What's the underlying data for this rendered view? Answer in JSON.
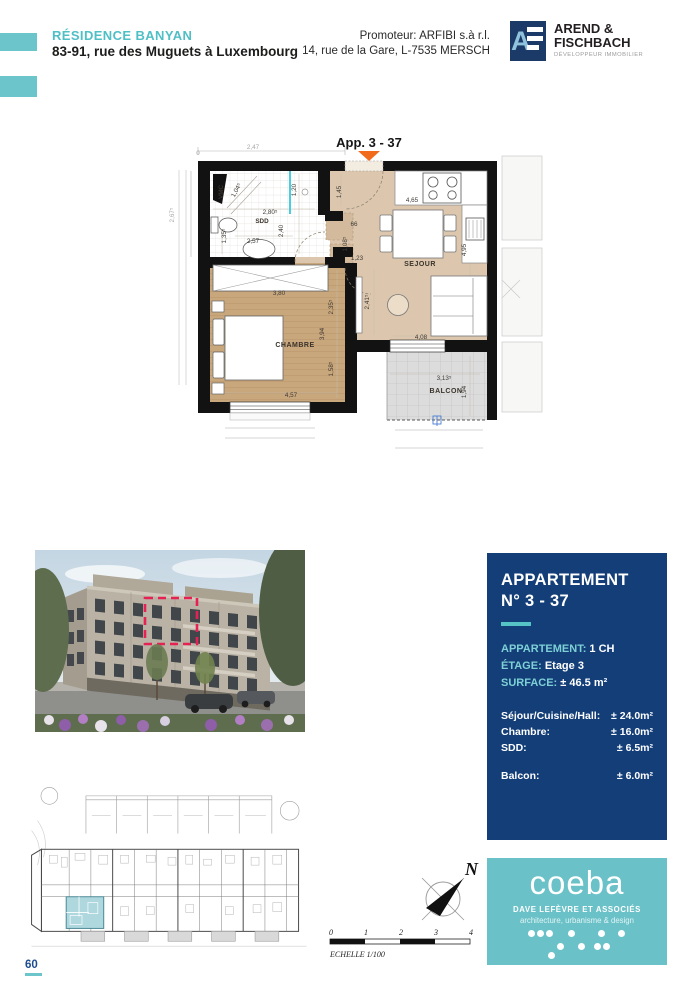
{
  "header": {
    "project_name": "RÉSIDENCE BANYAN",
    "project_address": "83-91, rue des Muguets à Luxembourg",
    "promoter_line1": "Promoteur: ARFIBI s.à r.l.",
    "promoter_line2": "14, rue de la Gare, L-7535 MERSCH",
    "developer": {
      "monogram_letter": "A",
      "name_line1": "AREND &",
      "name_line2": "FISCHBACH",
      "tagline": "DÉVELOPPEUR IMMOBILIER"
    }
  },
  "floor_plan": {
    "labels": [
      {
        "text": "App. 3 - 37",
        "x": 204,
        "y": 17,
        "cls": "app"
      },
      {
        "text": "0",
        "x": 33,
        "y": 25,
        "cls": "dim-out"
      },
      {
        "text": "2,47",
        "x": 88,
        "y": 19,
        "cls": "dim-out"
      },
      {
        "text": "2,67⁵",
        "x": 9,
        "y": 85,
        "rot": -90,
        "cls": "dim-out"
      },
      {
        "text": "VMC",
        "x": 58,
        "y": 62,
        "rot": -90,
        "cls": "room-sm"
      },
      {
        "text": "1,04⁵",
        "x": 73,
        "y": 61,
        "rot": -62,
        "cls": "dim"
      },
      {
        "text": "2,80⁵",
        "x": 105,
        "y": 84,
        "cls": "dim"
      },
      {
        "text": "1,20",
        "x": 131,
        "y": 60,
        "rot": -90,
        "cls": "dim"
      },
      {
        "text": "2,40",
        "x": 118,
        "y": 101,
        "rot": -90,
        "cls": "dim"
      },
      {
        "text": "SDD",
        "x": 97,
        "y": 93,
        "cls": "room-sm"
      },
      {
        "text": "2,57",
        "x": 88,
        "y": 113,
        "cls": "dim"
      },
      {
        "text": "1,35⁵",
        "x": 61,
        "y": 106,
        "rot": -90,
        "cls": "dim"
      },
      {
        "text": "1,45",
        "x": 176,
        "y": 62,
        "rot": -90,
        "cls": "dim"
      },
      {
        "text": "4,65",
        "x": 247,
        "y": 72,
        "cls": "dim"
      },
      {
        "text": "66",
        "x": 189,
        "y": 96,
        "cls": "dim"
      },
      {
        "text": "1,08⁵",
        "x": 182,
        "y": 114,
        "rot": -90,
        "cls": "dim"
      },
      {
        "text": "1,23",
        "x": 192,
        "y": 130,
        "cls": "dim"
      },
      {
        "text": "SEJOUR",
        "x": 255,
        "y": 136,
        "cls": "room"
      },
      {
        "text": "4,95",
        "x": 301,
        "y": 120,
        "rot": -90,
        "cls": "dim"
      },
      {
        "text": "2,41⁵",
        "x": 204,
        "y": 172,
        "rot": -90,
        "cls": "dim"
      },
      {
        "text": "4,08",
        "x": 256,
        "y": 209,
        "cls": "dim"
      },
      {
        "text": "3,80",
        "x": 114,
        "y": 165,
        "cls": "dim"
      },
      {
        "text": "2,35⁵",
        "x": 168,
        "y": 177,
        "rot": -90,
        "cls": "dim"
      },
      {
        "text": "3,94",
        "x": 159,
        "y": 204,
        "rot": -90,
        "cls": "dim"
      },
      {
        "text": "CHAMBRE",
        "x": 130,
        "y": 217,
        "cls": "room"
      },
      {
        "text": "1,58⁵",
        "x": 168,
        "y": 239,
        "rot": -90,
        "cls": "dim"
      },
      {
        "text": "4,57",
        "x": 126,
        "y": 267,
        "cls": "dim"
      },
      {
        "text": "3,13⁵",
        "x": 279,
        "y": 250,
        "cls": "dim"
      },
      {
        "text": "BALCON",
        "x": 281,
        "y": 263,
        "cls": "room"
      },
      {
        "text": "1,94",
        "x": 301,
        "y": 262,
        "rot": -90,
        "cls": "dim"
      }
    ]
  },
  "info_panel": {
    "title_line1": "APPARTEMENT",
    "title_line2": "N° 3 - 37",
    "specs": [
      {
        "label": "APPARTEMENT:",
        "value": "1 CH"
      },
      {
        "label": "ÉTAGE:",
        "value": "Etage 3"
      },
      {
        "label": "SURFACE:",
        "value": "± 46.5 m²"
      }
    ],
    "areas": [
      {
        "label": "Séjour/Cuisine/Hall:",
        "value": "± 24.0m²"
      },
      {
        "label": "Chambre:",
        "value": "± 16.0m²"
      },
      {
        "label": "SDD:",
        "value": "± 6.5m²"
      }
    ],
    "areas_secondary": [
      {
        "label": "Balcon:",
        "value": "± 6.0m²"
      }
    ]
  },
  "compass": {
    "north_label": "N"
  },
  "scale_bar": {
    "ticks": [
      "0",
      "1",
      "2",
      "3",
      "4"
    ],
    "label": "ECHELLE  1/100"
  },
  "architect_logo": {
    "name": "coeba",
    "subtitle": "DAVE LEFÈVRE ET ASSOCIÉS",
    "tagline": "architecture, urbanisme & design",
    "dots": [
      [
        41,
        72
      ],
      [
        50,
        72
      ],
      [
        59,
        72
      ],
      [
        81,
        72
      ],
      [
        111,
        72
      ],
      [
        131,
        72
      ],
      [
        70,
        85
      ],
      [
        91,
        85
      ],
      [
        107,
        85
      ],
      [
        116,
        85
      ],
      [
        61,
        94
      ]
    ]
  },
  "page_number": "60",
  "colors": {
    "accent_teal": "#6ac2c8",
    "navy_panel": "#133e78",
    "orange_marker": "#f26a1b",
    "highlight_dash_red": "#e62153",
    "floor_tan": "#dcc7ae",
    "floor_wood": "#c9a77c",
    "site_highlight": "#aed7de"
  }
}
